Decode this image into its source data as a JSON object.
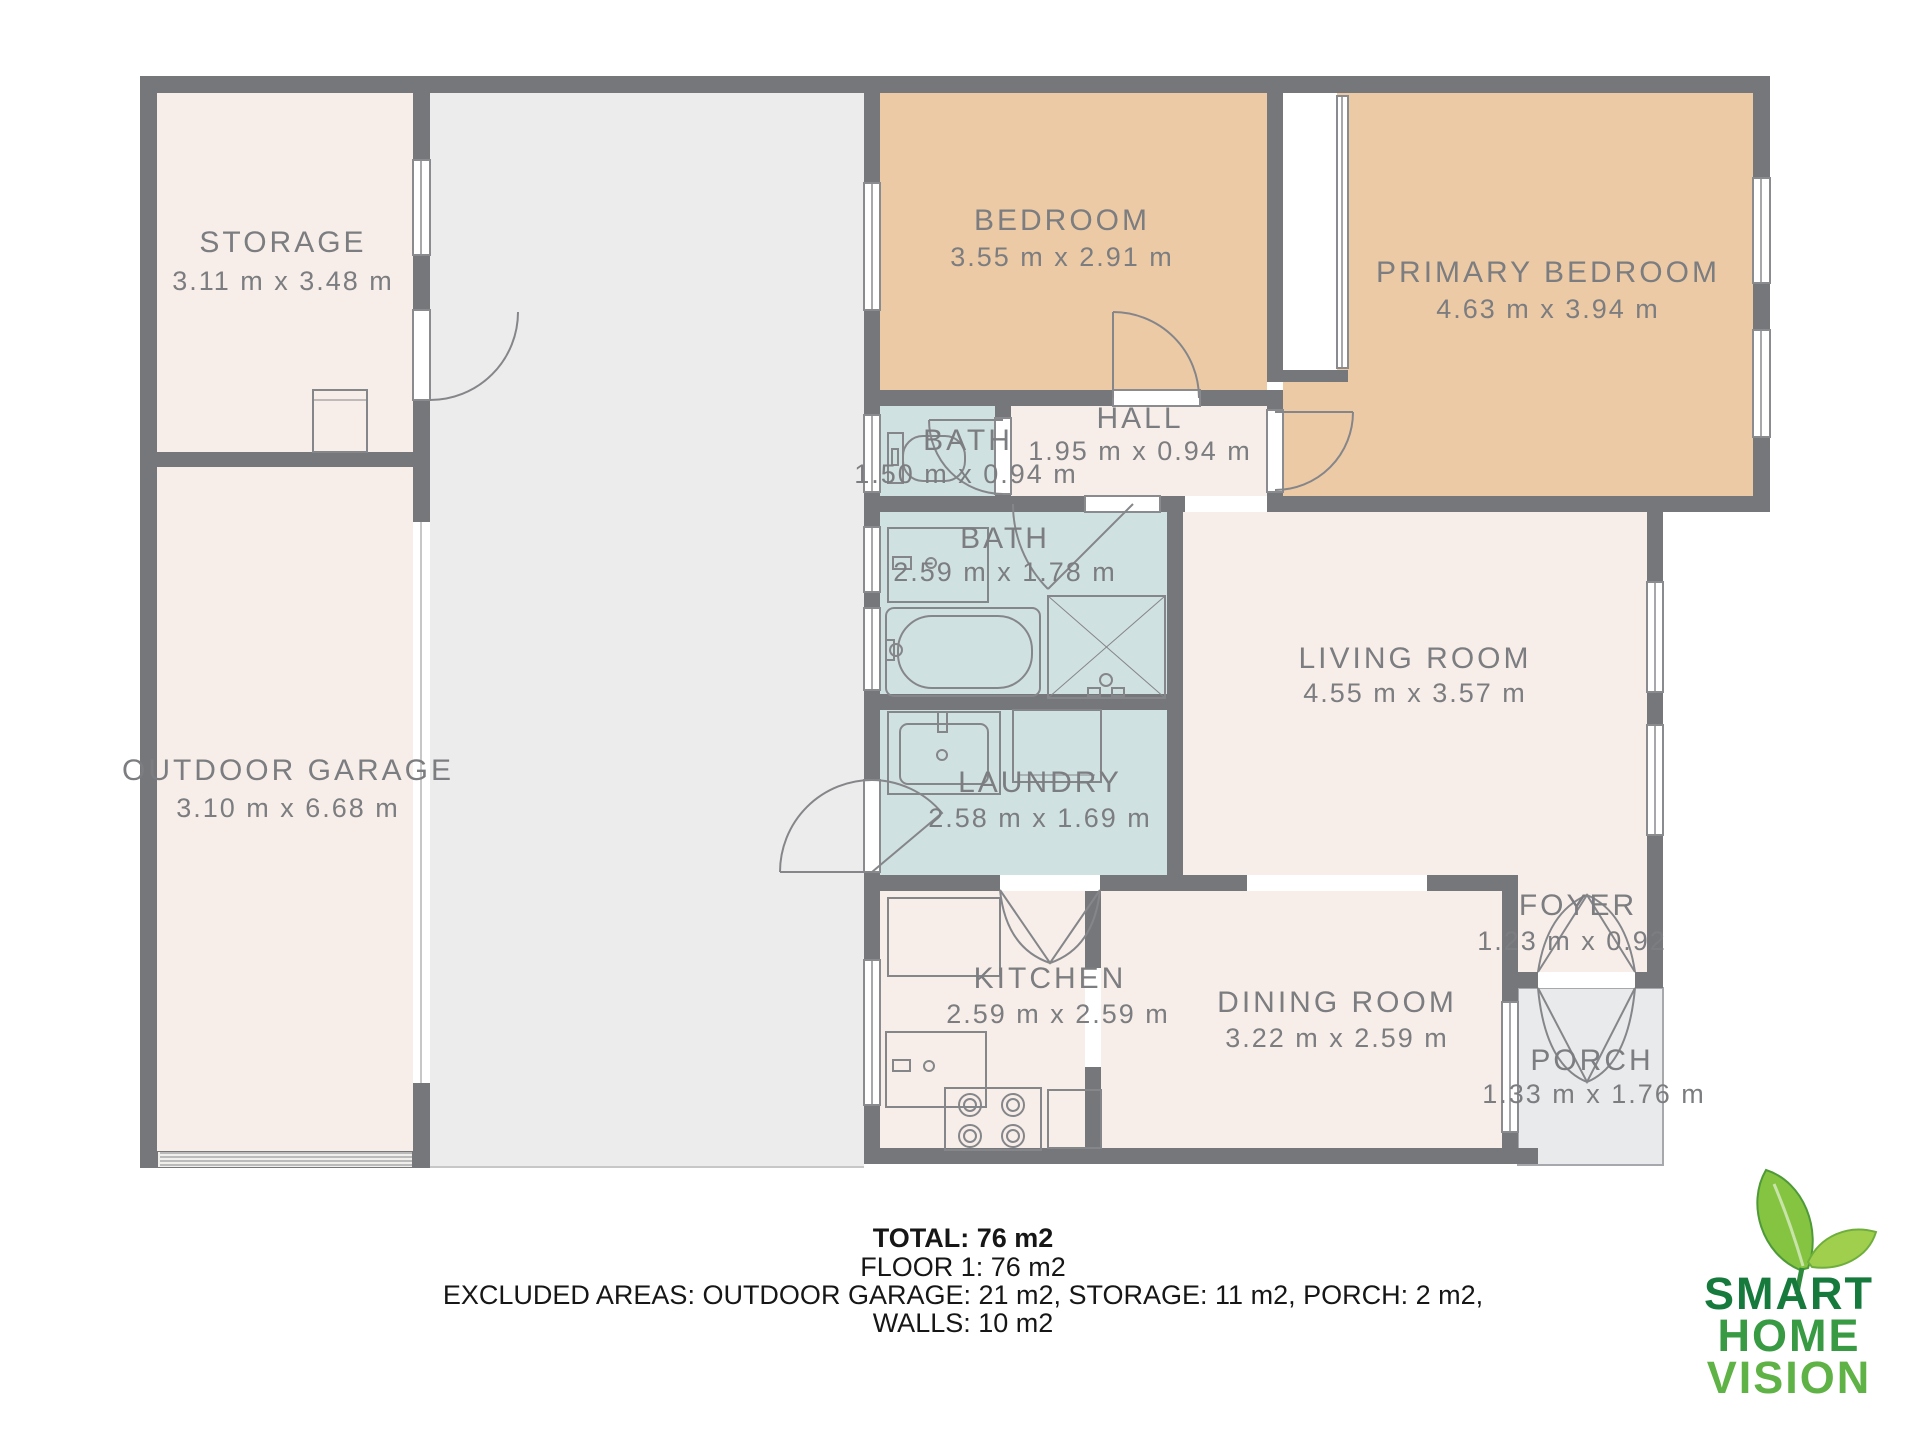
{
  "plan": {
    "rooms": {
      "storage": {
        "name": "STORAGE",
        "dims": "3.11 m x 3.48 m"
      },
      "garage": {
        "name": "OUTDOOR GARAGE",
        "dims": "3.10 m x 6.68 m"
      },
      "bedroom": {
        "name": "BEDROOM",
        "dims": "3.55 m x 2.91 m"
      },
      "primary_bedroom": {
        "name": "PRIMARY BEDROOM",
        "dims": "4.63 m x 3.94 m"
      },
      "bath_small": {
        "name": "BATH",
        "dims": "1.50 m x 0.94 m"
      },
      "hall": {
        "name": "HALL",
        "dims": "1.95 m x 0.94 m"
      },
      "bath_main": {
        "name": "BATH",
        "dims": "2.59 m x 1.78 m"
      },
      "living_room": {
        "name": "LIVING ROOM",
        "dims": "4.55 m x 3.57 m"
      },
      "laundry": {
        "name": "LAUNDRY",
        "dims": "2.58 m x 1.69 m"
      },
      "kitchen": {
        "name": "KITCHEN",
        "dims": "2.59 m x 2.59 m"
      },
      "dining_room": {
        "name": "DINING ROOM",
        "dims": "3.22 m x 2.59 m"
      },
      "foyer": {
        "name": "FOYER",
        "dims": "1.23 m x 0.92"
      },
      "porch": {
        "name": "PORCH",
        "dims": "1.33 m x 1.76 m"
      }
    },
    "colors": {
      "wall": "#76777b",
      "room_fill": "#f7eee9",
      "bedroom_fill": "#eccaa5",
      "bath_fill": "#d0e1e1",
      "outdoor_fill": "#ececec",
      "porch_fill": "#e9eaeb",
      "label": "#7c7d80",
      "line": "#85868a",
      "logo_dark_green": "#177a3d",
      "logo_mid_green": "#389a42",
      "logo_light_green": "#5fb245"
    }
  },
  "summary": {
    "total": "TOTAL: 76 m2",
    "floor": "FLOOR 1: 76 m2",
    "excluded": "EXCLUDED AREAS: OUTDOOR GARAGE: 21 m2, STORAGE: 11 m2, PORCH: 2 m2,",
    "walls": "WALLS: 10 m2"
  },
  "logo": {
    "line1": "SMART",
    "line2": "HOME",
    "line3": "VISION"
  }
}
